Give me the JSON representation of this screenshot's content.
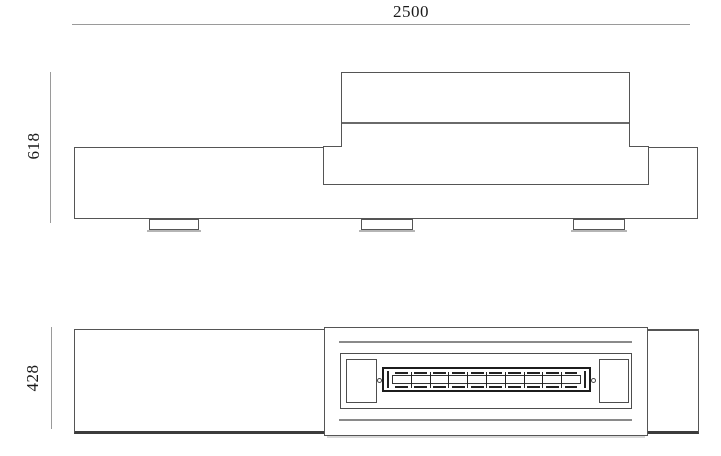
{
  "drawing": {
    "type": "furniture-technical-drawing",
    "dimensions": {
      "width_label": "2500",
      "height_label": "618",
      "depth_label": "428"
    },
    "plan": {
      "burner_segments": 10
    },
    "colors": {
      "outline": "#555555",
      "dim_line": "#9a9a9a",
      "burner_outline": "#1c1c1c",
      "groove": "#8a8a8a",
      "shadow": "#b5b5b5",
      "background": "#ffffff"
    }
  }
}
